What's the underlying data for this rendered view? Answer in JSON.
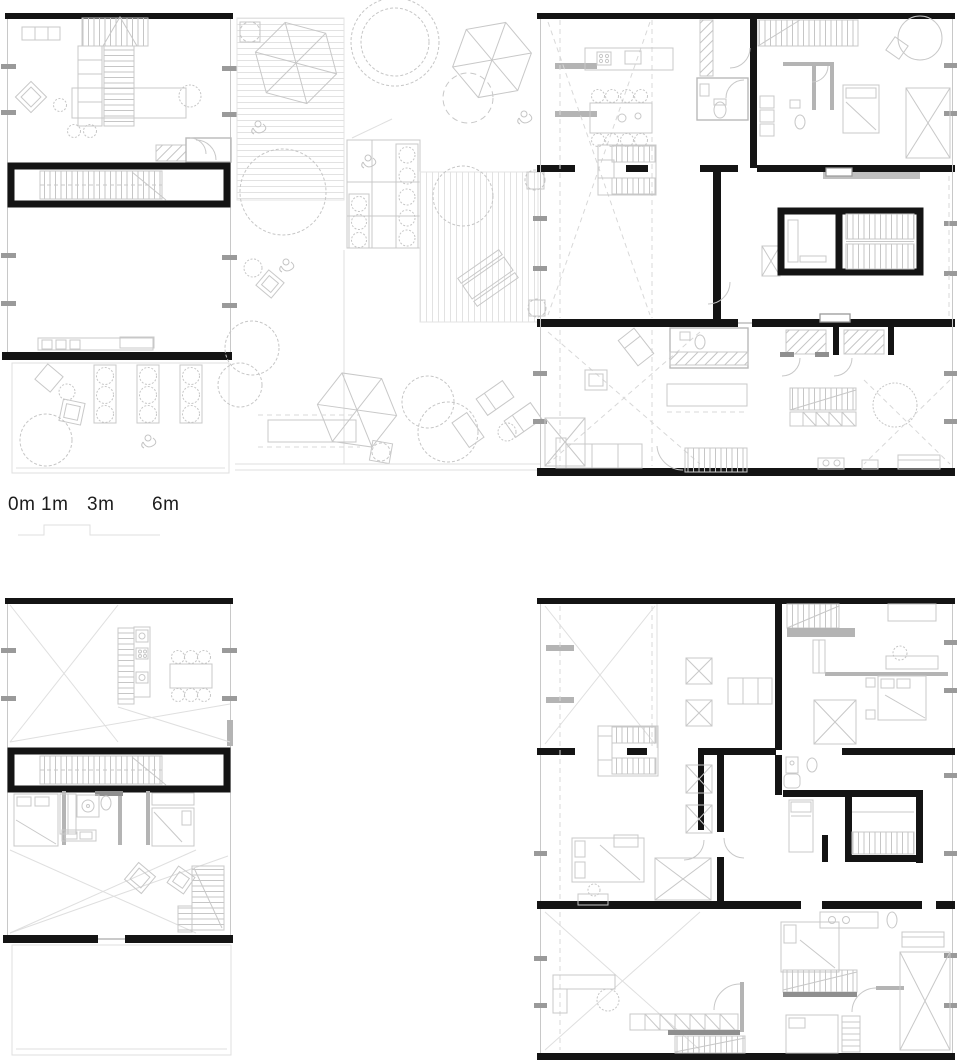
{
  "drawing": {
    "type": "architectural-floor-plans",
    "panels": [
      "upper-left-unit-plan",
      "roof-garden-plan",
      "upper-right-units-plan",
      "lower-left-unit-plan",
      "lower-right-units-plan"
    ]
  },
  "scale_bar": {
    "labels": [
      "0m",
      "1m",
      "3m",
      "6m"
    ]
  },
  "colors": {
    "wall": "#141414",
    "line_light": "#c8c8c8",
    "line_faint": "#dfdfdf",
    "line_mid": "#9a9a9a",
    "background": "#ffffff",
    "text": "#1d1d1d"
  }
}
